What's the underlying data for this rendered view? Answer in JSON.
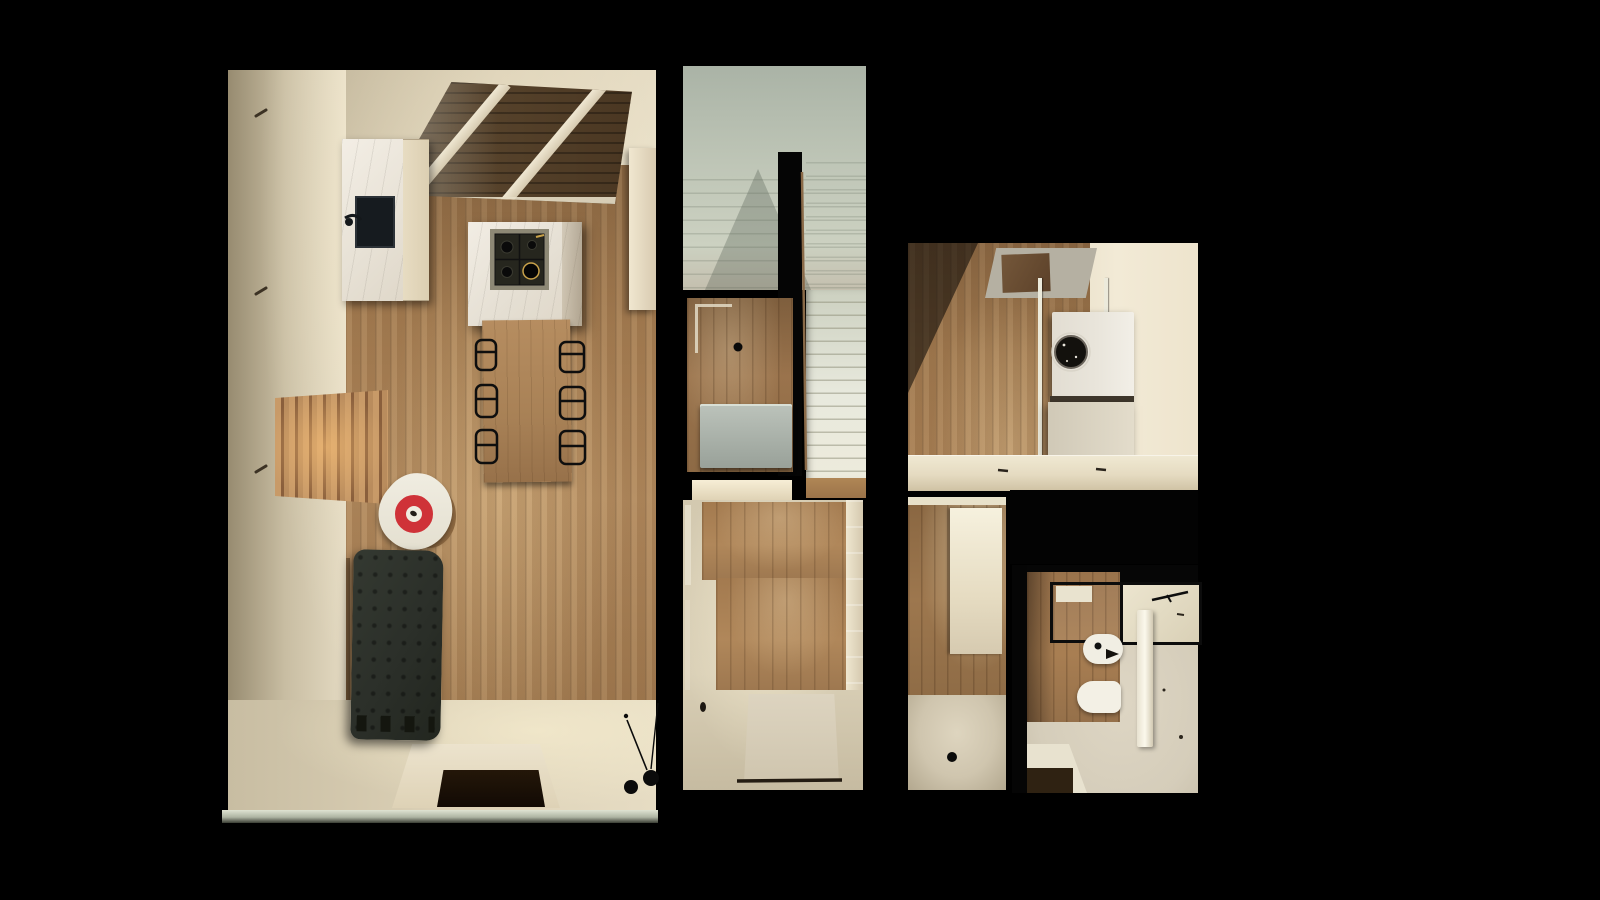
{
  "scene": {
    "title": "Top-down 3D render of a small apartment floor plan on a black background",
    "background": "#000000"
  },
  "palette": {
    "bg": "#000000",
    "wall-cream": "#e6ddc8",
    "wall-cream-bright": "#f2ead6",
    "wall-cream-dim": "#b3a78b",
    "wood-mid": "#a67e53",
    "wood-light": "#b28a5e",
    "wood-dark": "#8a6743",
    "wood-deep": "#4a3722",
    "marble": "#ebe6dd",
    "sage": "#b9c1b2",
    "sage-light": "#d6dbcc",
    "stair-white": "#e8e9dd",
    "black-wall": "#050505",
    "sofa": "#2b2f29",
    "red": "#cf3238",
    "floor-beige": "#d9cfb6",
    "void-dark": "#160f08",
    "gray-cabinet": "#a9b1a9"
  },
  "rooms": [
    {
      "id": "living-kitchen",
      "label": "Open living room with kitchen island, dining table, armchair and sofa"
    },
    {
      "id": "stairwell",
      "label": "Glazed stairwell with white staircase and wooden railing"
    },
    {
      "id": "storage-wc",
      "label": "Small under-stair room with grey cabinet"
    },
    {
      "id": "entry-hall",
      "label": "Entry hallway with doormat and closets"
    },
    {
      "id": "laundry-walk-in",
      "label": "Walk-in room with stacked washer unit and ceiling opening"
    },
    {
      "id": "corridor",
      "label": "Narrow corridor with white door"
    },
    {
      "id": "bathroom",
      "label": "Bathroom with bidet, wall-hung toilet, vanity and glass screens"
    }
  ],
  "furniture": {
    "skylight_living": "Glazed ceiling opening with cream beams",
    "sink_cabinet": "Marble kitchen cabinet with dark sink and faucet",
    "tall_cabinet": "Cream tall kitchen cabinet",
    "island": "Marble kitchen island with four-burner gas cooktop",
    "dining_table": "Wooden dining table with six black wireframe chairs",
    "armchair": "White armchair with red ring cushion",
    "sofa": "Dark tufted chaise sofa with wooden side frame",
    "slat_panel": "Backlit vertical wood slat panel",
    "floor_opening": "Dark floor opening with light surround",
    "floor_lamp": "Black floor lamp with thin arms",
    "glass_edge": "Glass balustrade edge strip",
    "staircase": "White staircase treads",
    "stair_wall": "Black stair partition wall",
    "railing": "Thin wooden stair railing",
    "under_stair_cabinet": "Grey-green cabinet in under-stair room",
    "threshold": "Lit door threshold",
    "doormat": "Beige entry doormat with dark threshold line",
    "hall_closet": "Light closet front along hallway wall",
    "skylight_laundry": "Ceiling opening above walk-in room",
    "clothes_poles": "Two white floor-to-ceiling poles",
    "washer_unit": "Stacked marble laundry cubes with round black washer door",
    "counter": "Built-in cream counter band",
    "void_block": "Black built-in volume",
    "white_door": "Bright white corridor door",
    "bidet": "Bidet with chrome spout",
    "toilet": "Wall-hung toilet",
    "vanity": "Vanity counter with faucet behind glass screen",
    "shower_screen": "Black-framed glass screen",
    "divider_wall": "White partition wall",
    "bath_mat": "Dark bath mat under corner counter"
  }
}
